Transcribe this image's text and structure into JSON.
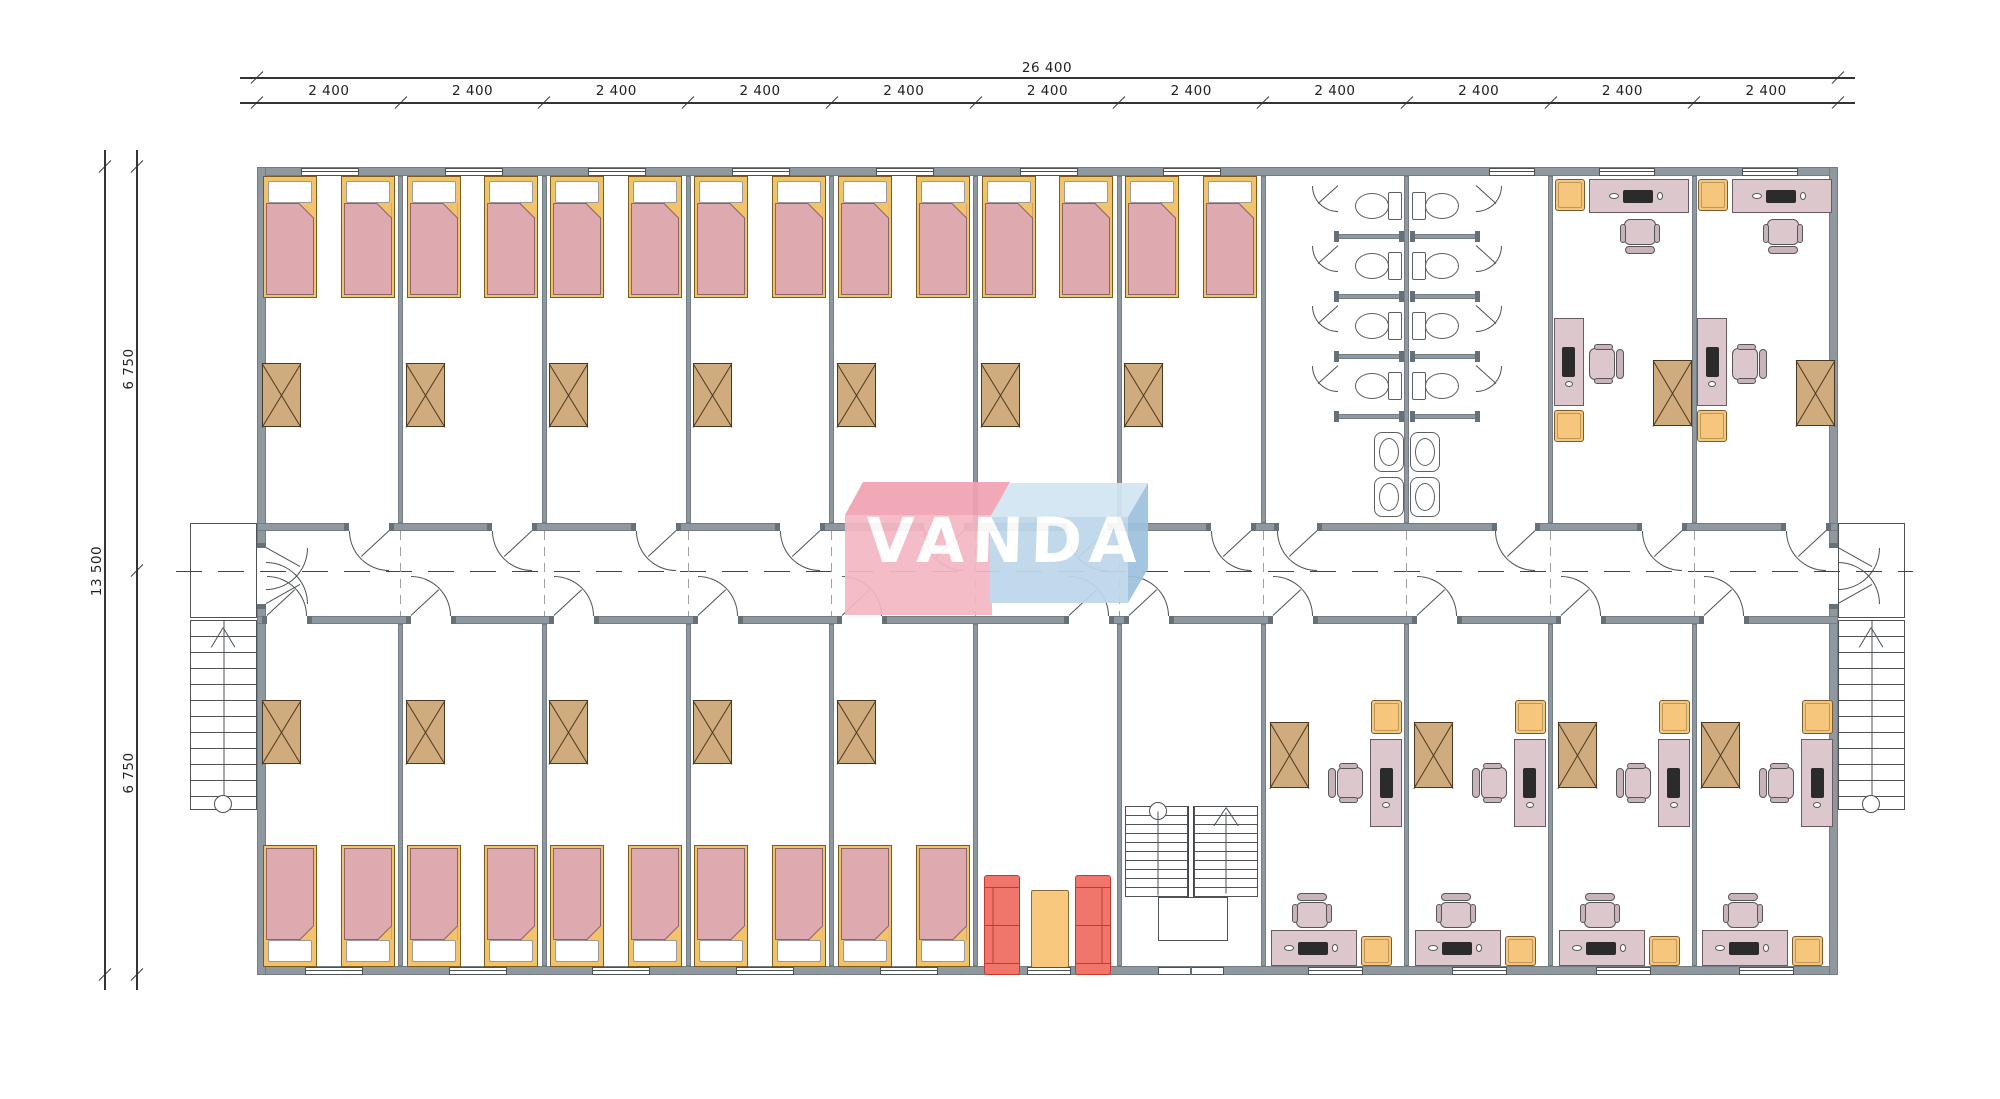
{
  "title": "VANDA modular dormitory floor plan",
  "logo": {
    "text": "VANDA"
  },
  "dimensions": {
    "horizontal_total": "26 400",
    "horizontal_segments": [
      "2 400",
      "2 400",
      "2 400",
      "2 400",
      "2 400",
      "2 400",
      "2 400",
      "2 400",
      "2 400",
      "2 400",
      "2 400"
    ],
    "vertical_total": "13 500",
    "vertical_segments": [
      "6 750",
      "6 750"
    ]
  },
  "zones": {
    "top": {
      "bedrooms": 7,
      "beds_per_room": 2,
      "wardrobes_per_room": 1,
      "toilet_stalls": 8,
      "toilet_rows": 4,
      "sinks": 4,
      "offices": 2
    },
    "bottom": {
      "bedrooms": 5,
      "beds_per_room": 2,
      "offices": 4,
      "lounge_sofas": 2,
      "lounge_tables": 1
    },
    "stairs": {
      "external": 2,
      "internal": 1
    }
  },
  "colors": {
    "wall": "#8f979f",
    "wall_dark": "#667078",
    "line": "#4d5256",
    "dim_line": "#333333",
    "dim_text": "#1f1f1f",
    "bed_frame": "#f2c36b",
    "bed_frame_border": "#7a5c20",
    "blanket": "#dfa9b0",
    "blanket_border": "#8a6468",
    "pillow": "#ffffff",
    "wardrobe": "#cfab7d",
    "wardrobe_border": "#4a3a22",
    "desk": "#dbc7cc",
    "desk_border": "#6d5a60",
    "computer": "#2b2b2b",
    "cabinet": "#f5c67c",
    "cabinet_border": "#7a5c30",
    "sofa": "#f0756a",
    "sofa_border": "#bf3b30",
    "table": "#f8c87e",
    "table_border": "#8a6a3a",
    "fixture": "#5a5f63",
    "logo_red": "#f3b7c2",
    "logo_red_top": "#f0a2b2",
    "logo_blue": "#bdd7ea",
    "logo_blue_top": "#d3e6f4",
    "logo_blue_side": "#9dc1dd",
    "logo_text": "#ffffff"
  }
}
